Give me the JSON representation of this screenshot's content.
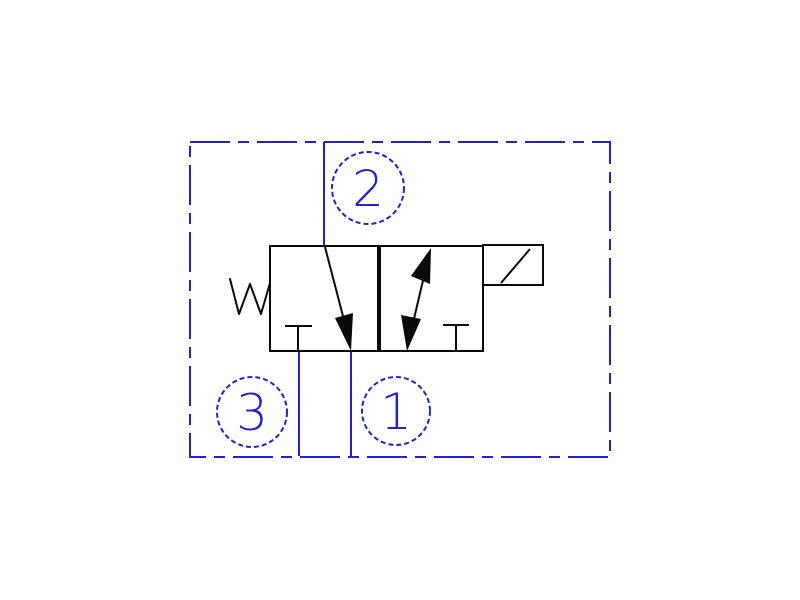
{
  "diagram": {
    "type": "hydraulic-valve-symbol-3way-2position",
    "ports": {
      "port2": {
        "label": "2",
        "position": "top"
      },
      "port3": {
        "label": "3",
        "position": "bottom-left"
      },
      "port1": {
        "label": "1",
        "position": "bottom-center"
      }
    },
    "symbols": {
      "spring": "return-spring-zigzag",
      "solenoid": "solenoid-actuator-box",
      "left_position": "flow-arrow-2-to-1-with-blocked-port-3",
      "right_position": "double-headed-flow-arrow-with-blocked-port"
    },
    "colors": {
      "envelope_blue": "#2222cc",
      "symbol_black": "#0a0a0a",
      "background": "#ffffff"
    }
  }
}
